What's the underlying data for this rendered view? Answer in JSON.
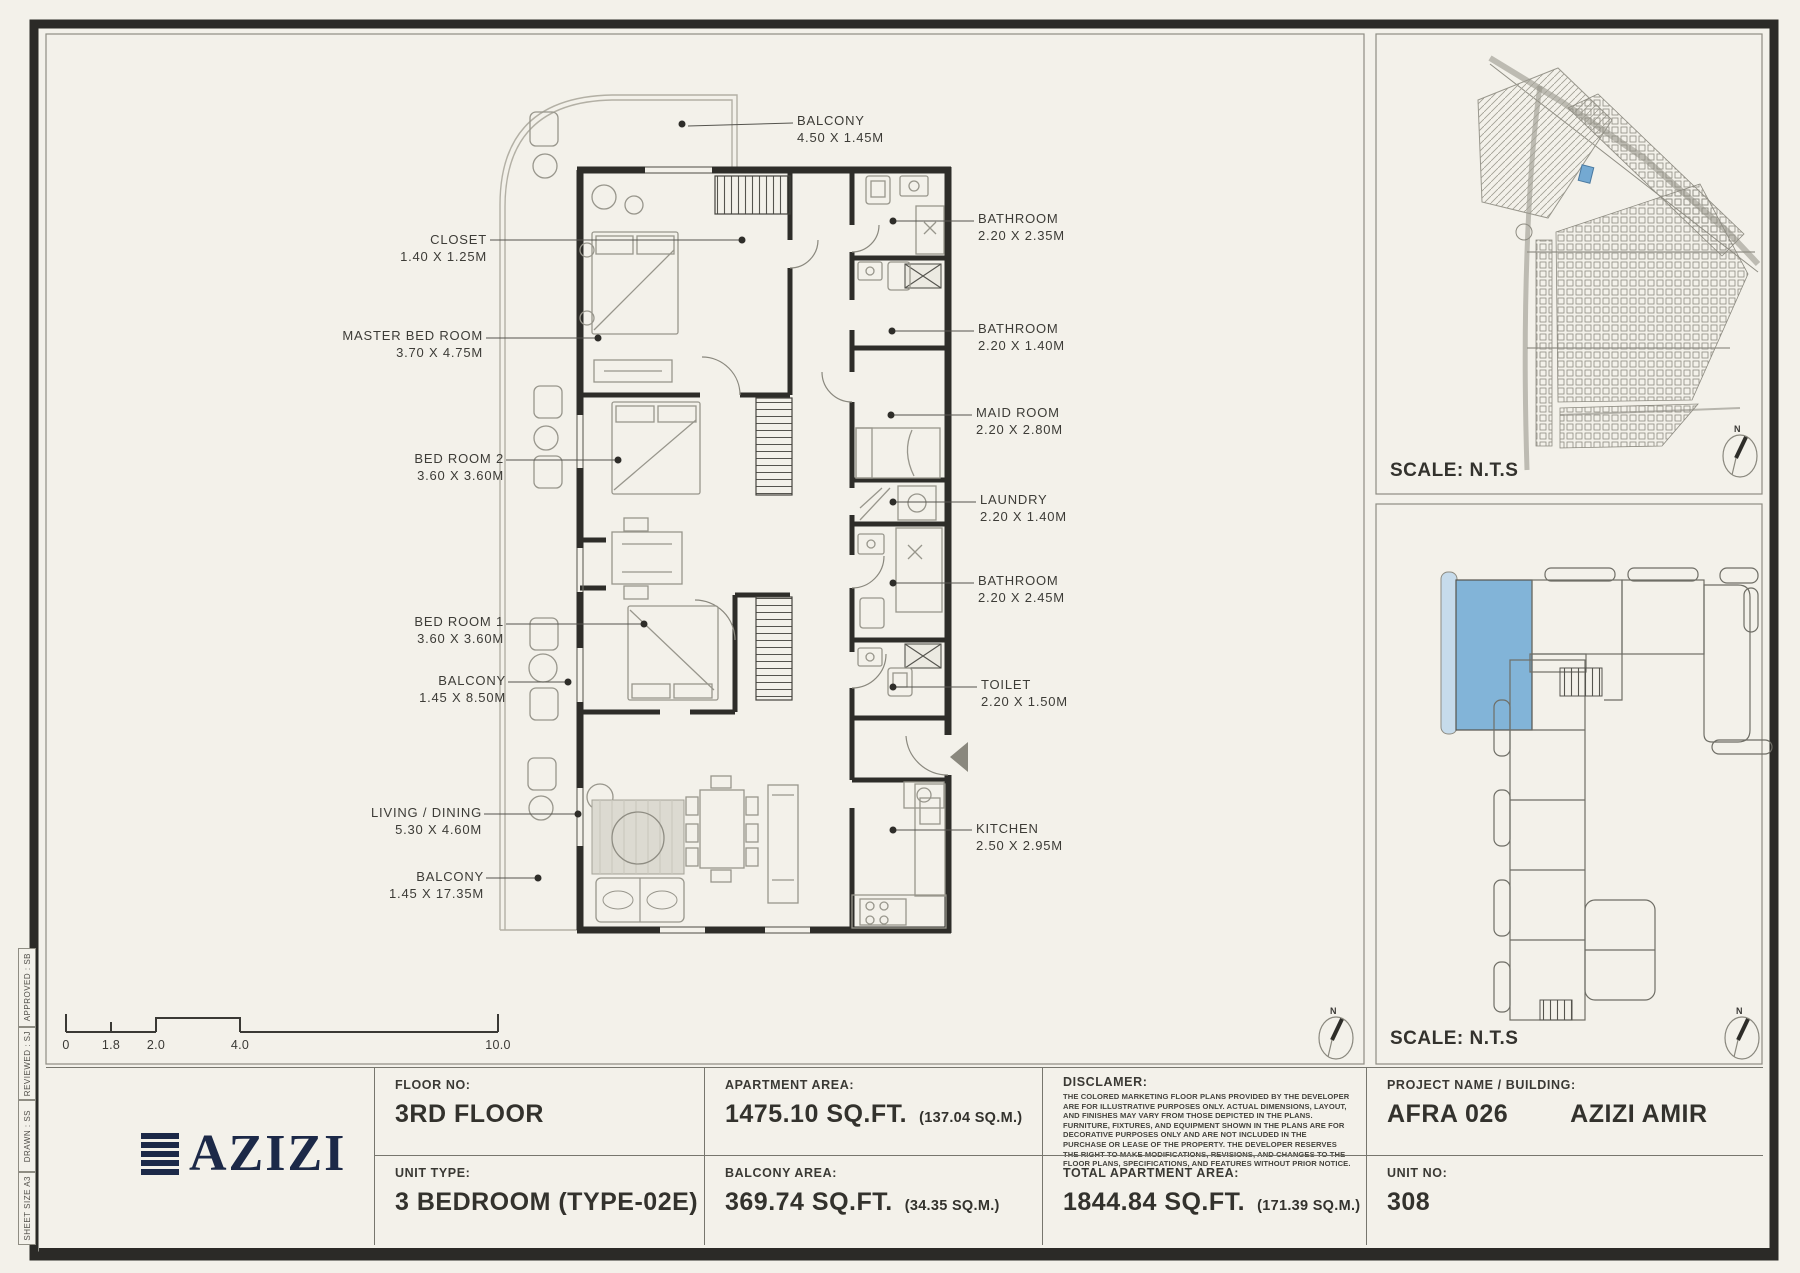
{
  "floor_plan": {
    "labels": [
      {
        "name": "CLOSET",
        "dims": "1.40 X 1.25M"
      },
      {
        "name": "MASTER BED ROOM",
        "dims": "3.70 X 4.75M"
      },
      {
        "name": "BED ROOM 2",
        "dims": "3.60 X 3.60M"
      },
      {
        "name": "BED ROOM 1",
        "dims": "3.60 X 3.60M"
      },
      {
        "name": "BALCONY",
        "dims": "1.45 X 8.50M"
      },
      {
        "name": "LIVING / DINING",
        "dims": "5.30 X 4.60M"
      },
      {
        "name": "BALCONY",
        "dims": "1.45 X 17.35M"
      },
      {
        "name": "BALCONY",
        "dims": "4.50 X 1.45M"
      },
      {
        "name": "BATHROOM",
        "dims": "2.20 X 2.35M"
      },
      {
        "name": "BATHROOM",
        "dims": "2.20 X 1.40M"
      },
      {
        "name": "MAID ROOM",
        "dims": "2.20 X 2.80M"
      },
      {
        "name": "LAUNDRY",
        "dims": "2.20 X 1.40M"
      },
      {
        "name": "BATHROOM",
        "dims": "2.20 X 2.45M"
      },
      {
        "name": "TOILET",
        "dims": "2.20 X 1.50M"
      },
      {
        "name": "KITCHEN",
        "dims": "2.50 X 2.95M"
      }
    ]
  },
  "scale_bar": {
    "ticks": [
      "0",
      "1.8",
      "2.0",
      "4.0",
      "10.0"
    ]
  },
  "map_panel": {
    "scale_label": "SCALE: N.T.S"
  },
  "key_plan_panel": {
    "scale_label": "SCALE: N.T.S"
  },
  "compass": {
    "north": "N"
  },
  "side_strip": {
    "approved": "APPROVED : SB",
    "reviewed": "REVIEWED : SJ",
    "drawn": "DRAWN : SS",
    "sheet_size": "SHEET SIZE A3"
  },
  "title_block": {
    "logo_text": "AZIZI",
    "floor_no_label": "FLOOR NO:",
    "floor_no": "3RD FLOOR",
    "unit_type_label": "UNIT TYPE:",
    "unit_type": "3 BEDROOM (TYPE-02E)",
    "apartment_area_label": "APARTMENT AREA:",
    "apartment_area": "1475.10 SQ.FT.",
    "apartment_area_sqm": "(137.04 SQ.M.)",
    "balcony_area_label": "BALCONY AREA:",
    "balcony_area": "369.74 SQ.FT.",
    "balcony_area_sqm": "(34.35 SQ.M.)",
    "disclaimer_label": "DISCLAMER:",
    "disclaimer_text": "THE COLORED MARKETING FLOOR PLANS PROVIDED BY THE DEVELOPER ARE FOR ILLUSTRATIVE PURPOSES ONLY. ACTUAL DIMENSIONS, LAYOUT, AND FINISHES MAY VARY FROM THOSE DEPICTED IN THE PLANS. FURNITURE, FIXTURES, AND EQUIPMENT SHOWN IN THE PLANS ARE FOR DECORATIVE PURPOSES ONLY AND ARE NOT INCLUDED IN THE PURCHASE OR LEASE OF THE PROPERTY. THE DEVELOPER RESERVES THE RIGHT TO MAKE MODIFICATIONS, REVISIONS, AND CHANGES TO THE FLOOR PLANS, SPECIFICATIONS, AND FEATURES WITHOUT PRIOR NOTICE.",
    "total_area_label": "TOTAL APARTMENT AREA:",
    "total_area": "1844.84 SQ.FT.",
    "total_area_sqm": "(171.39 SQ.M.)",
    "project_label": "PROJECT NAME / BUILDING:",
    "project_name": "AFRA 026",
    "building_name": "AZIZI AMIR",
    "unit_no_label": "UNIT NO:",
    "unit_no": "308"
  },
  "colors": {
    "paper": "#f3f1ea",
    "ink": "#2e2d29",
    "accent_blue": "#82b4d8",
    "navy": "#1c2948"
  }
}
